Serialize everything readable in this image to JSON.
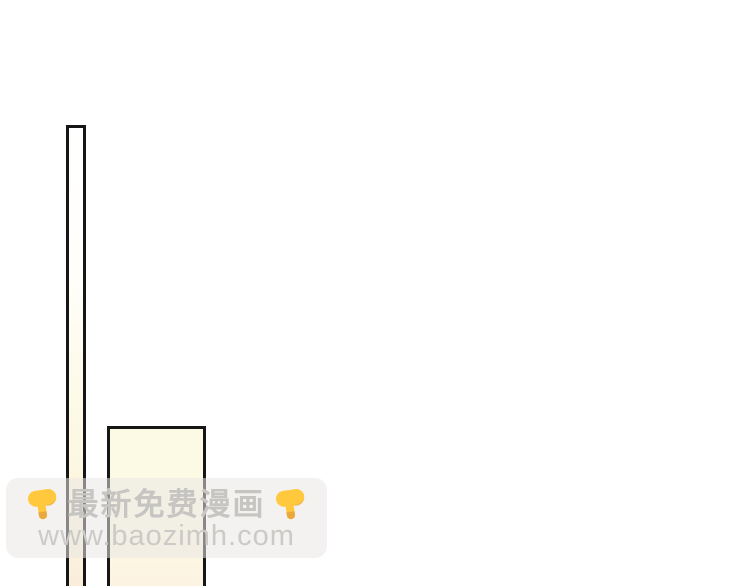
{
  "page": {
    "kind": "comic-page-strip",
    "background": "#ffffff"
  },
  "artwork": {
    "ink_color": "#161616",
    "pole_fill_top": "#ffffff",
    "pole_fill_bottom": "#f9ecd9",
    "panel_fill_top": "#fcfae4",
    "panel_fill_bottom": "#fbf2df"
  },
  "watermark": {
    "line1": "最新免费漫画",
    "line2": "www.baozimh.com",
    "left_icon": "pointing-down-finger",
    "right_icon": "pointing-down-finger",
    "band_color": "#e9e8e4",
    "text_color": "#c6c5c2",
    "emoji_yellow": "#FFC83D",
    "emoji_shade": "#E8A33D"
  }
}
